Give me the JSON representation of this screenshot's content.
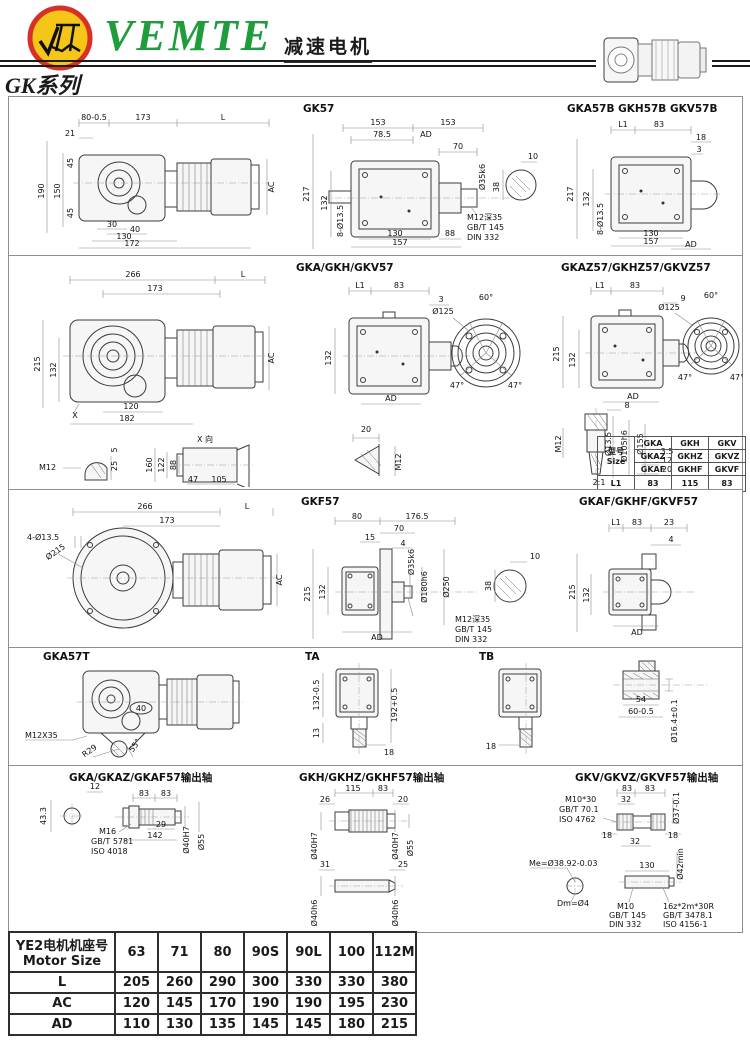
{
  "header": {
    "brand": "VEMTE",
    "doc_title": "减速电机",
    "series_title": "GK系列"
  },
  "icons": {
    "logo": "vemte-monogram-icon",
    "thumbnail": "gearmotor-thumbnail-icon"
  },
  "colors": {
    "brand_green": "#1f9d3c",
    "logo_red": "#d63027",
    "logo_yellow": "#f5c518",
    "line": "#3c3c3c"
  },
  "panels": {
    "p1a": {
      "dims": [
        "80-0.5",
        "173",
        "L",
        "21",
        "190",
        "150",
        "45",
        "45",
        "30",
        "40",
        "130",
        "172",
        "AC"
      ]
    },
    "p1b": {
      "title": "GK57",
      "dims": [
        "153",
        "153",
        "78.5",
        "AD",
        "70",
        "Ø35k6",
        "217",
        "132",
        "8-Ø13.5",
        "130",
        "88",
        "157",
        "M12深35",
        "GB/T 145",
        "DIN 332",
        "10",
        "38"
      ]
    },
    "p1c": {
      "title": "GKA57B  GKH57B  GKV57B",
      "dims": [
        "L1",
        "83",
        "18",
        "3",
        "217",
        "132",
        "8-Ø13.5",
        "130",
        "157",
        "AD"
      ]
    },
    "p2a": {
      "dims": [
        "266",
        "L",
        "173",
        "215",
        "132",
        "X",
        "120",
        "182",
        "AC",
        "M12",
        "5",
        "25",
        "X 向",
        "160",
        "122",
        "88",
        "47",
        "105"
      ]
    },
    "p2b": {
      "title": "GKA/GKH/GKV57",
      "dims": [
        "L1",
        "83",
        "3",
        "132",
        "AD",
        "60°",
        "Ø125",
        "47°",
        "47°",
        "20",
        "M12"
      ]
    },
    "p2c": {
      "title": "GKAZ57/GKHZ57/GKVZ57",
      "dims": [
        "L1",
        "83",
        "9",
        "215",
        "132",
        "AD",
        "60°",
        "Ø125",
        "47°",
        "47°",
        "M12",
        "8",
        "Ø13.5",
        "Ø105h6",
        "Ø155",
        "3.5",
        "12",
        "20",
        "2:1"
      ]
    },
    "p3a": {
      "dims": [
        "266",
        "L",
        "173",
        "4-Ø13.5",
        "Ø215",
        "AC"
      ]
    },
    "p3b": {
      "title": "GKF57",
      "dims": [
        "80",
        "176.5",
        "70",
        "15",
        "4",
        "215",
        "132",
        "Ø35k6",
        "Ø180h6",
        "Ø250",
        "AD",
        "M12深35",
        "GB/T 145",
        "DIN 332",
        "10",
        "38"
      ]
    },
    "p3c": {
      "title": "GKAF/GKHF/GKVF57",
      "dims": [
        "L1",
        "83",
        "23",
        "4",
        "215",
        "132",
        "AD"
      ]
    },
    "p4a": {
      "title": "GKA57T",
      "dims": [
        "M12X35",
        "R29",
        "55°",
        "40"
      ]
    },
    "p4b": {
      "title_a": "TA",
      "title_b": "TB",
      "dims": [
        "132-0.5",
        "13",
        "192+0.5",
        "18",
        "18"
      ]
    },
    "p4c": {
      "dims": [
        "54",
        "60-0.5",
        "Ø16.4±0.1"
      ]
    },
    "p5a": {
      "title": "GKA/GKAZ/GKAF57输出轴",
      "dims": [
        "12",
        "83",
        "83",
        "43.3",
        "M16",
        "GB/T 5781",
        "ISO 4018",
        "29",
        "142",
        "Ø40H7",
        "Ø55"
      ]
    },
    "p5b": {
      "title": "GKH/GKHZ/GKHF57输出轴",
      "dims": [
        "115",
        "83",
        "26",
        "20",
        "Ø40H7",
        "Ø40H7",
        "Ø55",
        "31",
        "25",
        "Ø40h6",
        "Ø40h6"
      ]
    },
    "p5c": {
      "title": "GKV/GKVZ/GKVF57输出轴",
      "dims": [
        "M10*30",
        "GB/T 70.1",
        "ISO 4762",
        "83",
        "83",
        "32",
        "Ø37-0.1",
        "18",
        "18",
        "32",
        "Ø42min",
        "130",
        "Me=Ø38.92-0.03",
        "Dm=Ø4",
        "M10",
        "GB/T 145",
        "DIN 332",
        "16z*2m*30R",
        "GB/T 3478.1",
        "ISO 4156-1"
      ]
    }
  },
  "size_table": {
    "header_cn": "型号",
    "header_en": "Size",
    "rows": [
      [
        "GKA",
        "GKH",
        "GKV"
      ],
      [
        "GKAZ",
        "GKHZ",
        "GKVZ"
      ],
      [
        "GKAF",
        "GKHF",
        "GKVF"
      ]
    ],
    "l1_label": "L1",
    "l1_values": [
      "83",
      "115",
      "83"
    ]
  },
  "motor_table": {
    "header_cn": "YE2电机机座号",
    "header_en": "Motor Size",
    "frame_sizes": [
      "63",
      "71",
      "80",
      "90S",
      "90L",
      "100",
      "112M"
    ],
    "rows": [
      {
        "label": "L",
        "values": [
          "205",
          "260",
          "290",
          "300",
          "330",
          "330",
          "380"
        ]
      },
      {
        "label": "AC",
        "values": [
          "120",
          "145",
          "170",
          "190",
          "190",
          "195",
          "230"
        ]
      },
      {
        "label": "AD",
        "values": [
          "110",
          "130",
          "135",
          "145",
          "145",
          "180",
          "215"
        ]
      }
    ]
  }
}
